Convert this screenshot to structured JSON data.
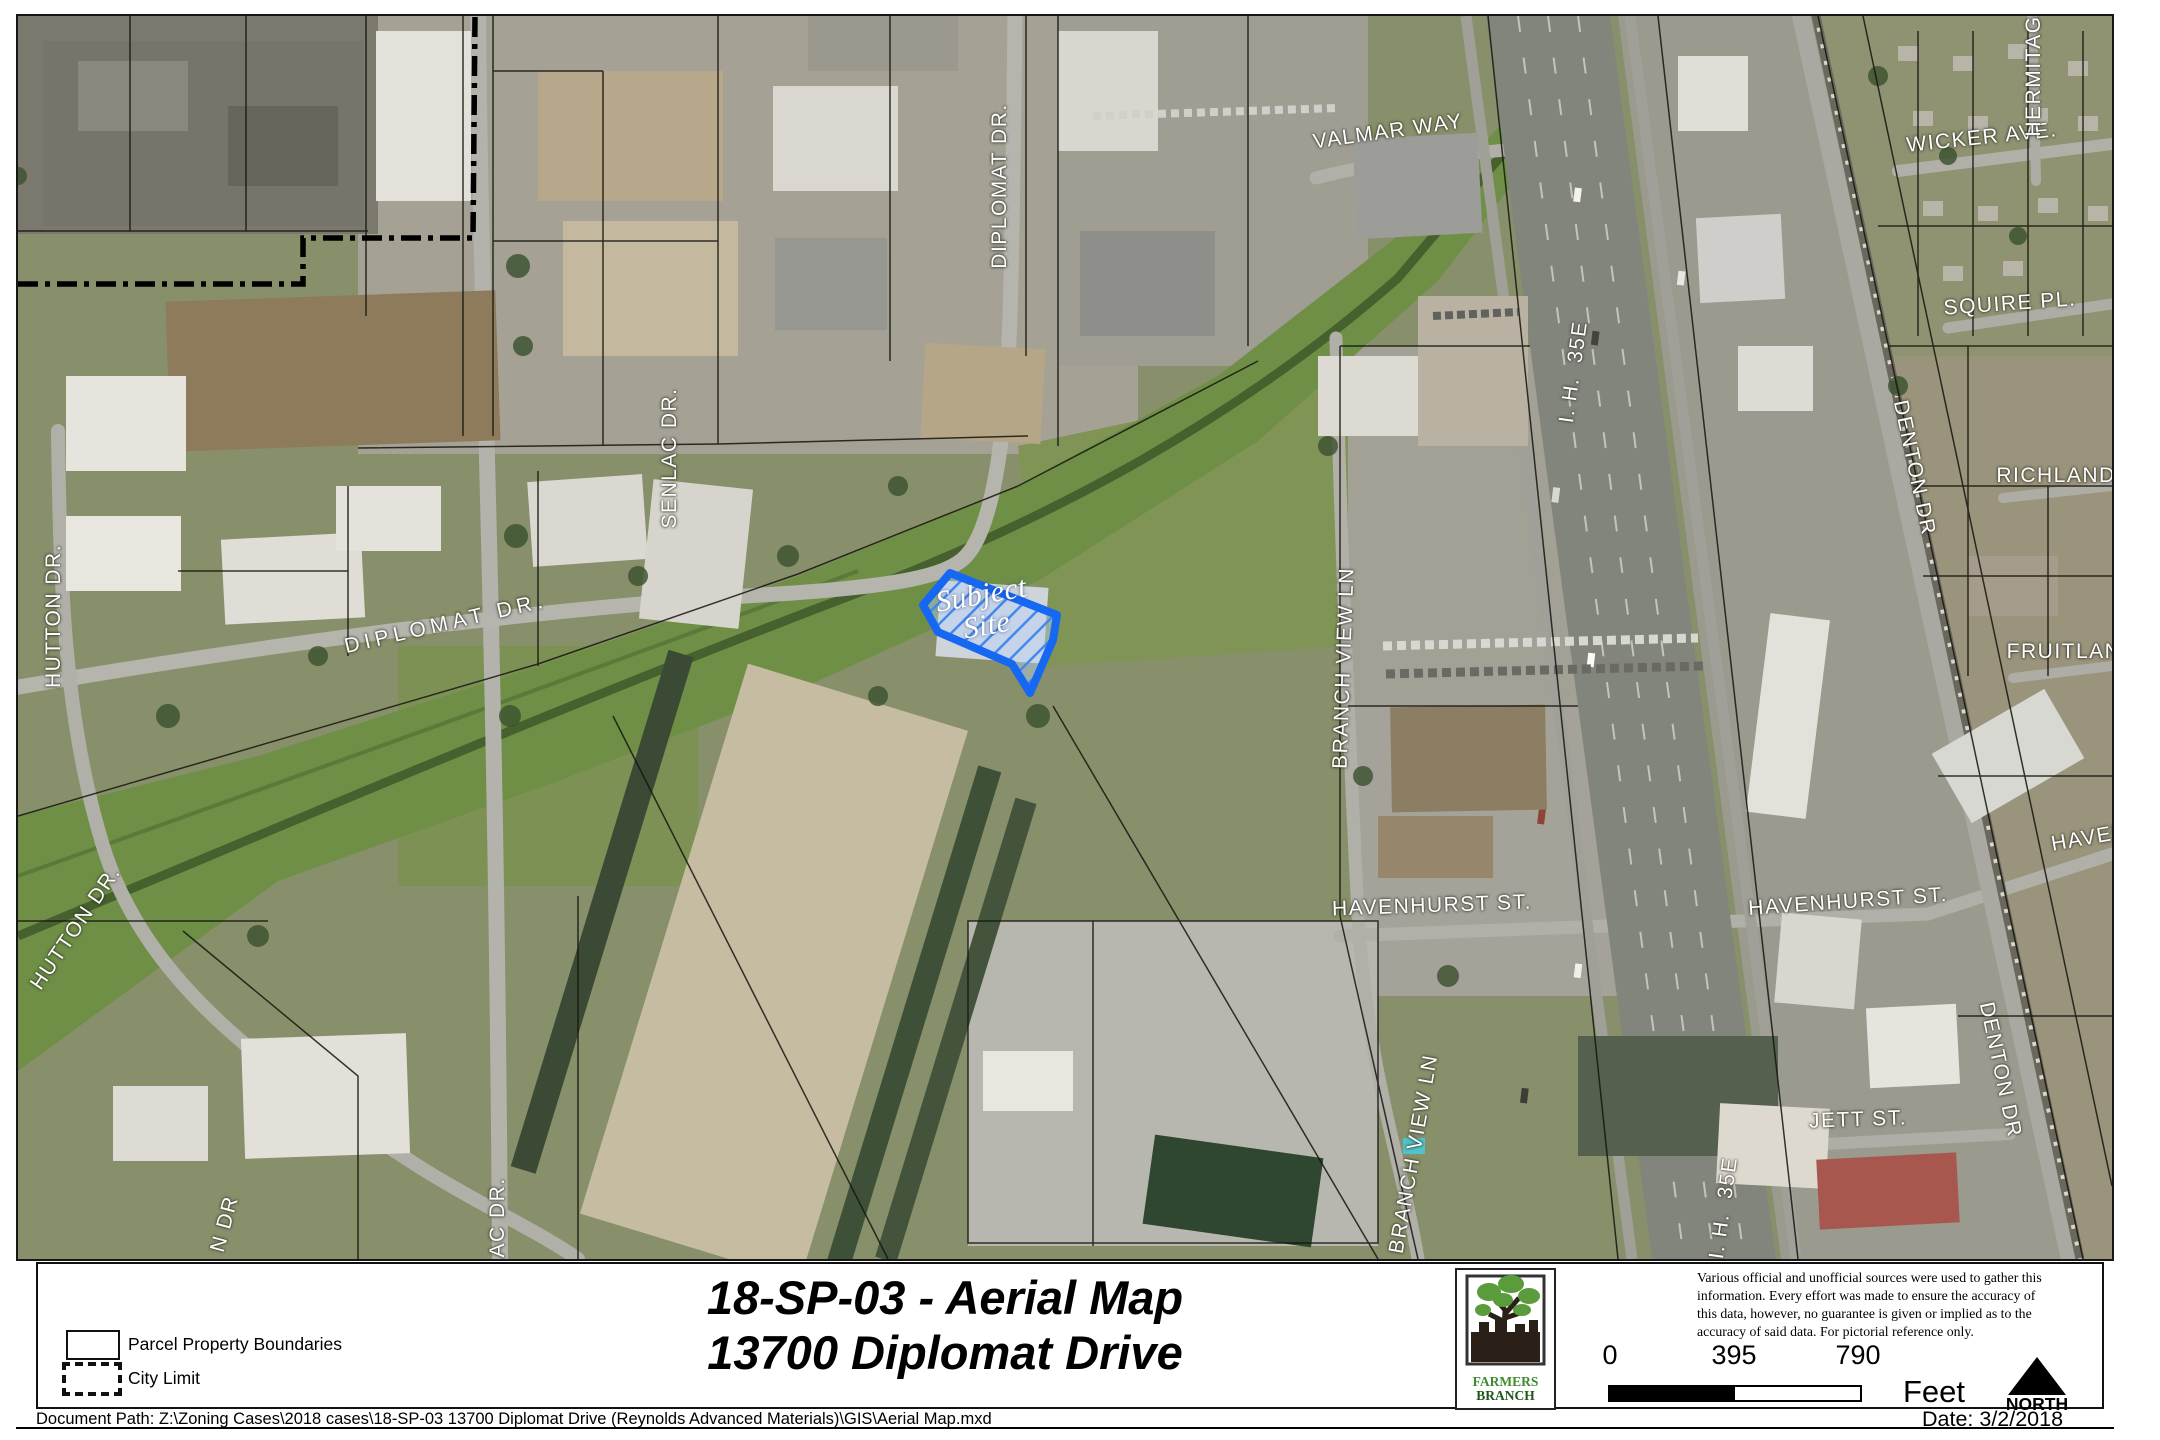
{
  "map": {
    "subject_outline_color": "#1668f2",
    "label_color": "#ffffff",
    "labels": [
      {
        "text": "HUTTON DR.",
        "x": 36,
        "y": 600,
        "rot": -90
      },
      {
        "text": "HUTTON DR.",
        "x": 58,
        "y": 912,
        "rot": -56
      },
      {
        "text": "N DR",
        "x": 207,
        "y": 1208,
        "rot": -75
      },
      {
        "text": "SENLAC DR.",
        "x": 652,
        "y": 442,
        "rot": -90
      },
      {
        "text": "LAC DR.",
        "x": 480,
        "y": 1208,
        "rot": -90
      },
      {
        "text": "DIPLOMAT DR.",
        "x": 982,
        "y": 170,
        "rot": -90
      },
      {
        "text": "DIPLOMAT DR.",
        "x": 428,
        "y": 608,
        "rot": -13,
        "cls": "spread"
      },
      {
        "text": "VALMAR WAY",
        "x": 1370,
        "y": 116,
        "rot": -8
      },
      {
        "text": "I. H.  35E",
        "x": 1556,
        "y": 356,
        "rot": -82
      },
      {
        "text": "I. H.  35E",
        "x": 1706,
        "y": 1192,
        "rot": -82
      },
      {
        "text": "BRANCH VIEW LN",
        "x": 1326,
        "y": 652,
        "rot": -88
      },
      {
        "text": "BRANCH VIEW LN",
        "x": 1396,
        "y": 1138,
        "rot": -80
      },
      {
        "text": "HAVENHURST ST.",
        "x": 1414,
        "y": 890,
        "rot": -2
      },
      {
        "text": "HAVENHURST ST.",
        "x": 1830,
        "y": 886,
        "rot": -4
      },
      {
        "text": "HAVEN",
        "x": 2072,
        "y": 822,
        "rot": -10
      },
      {
        "text": "JETT ST.",
        "x": 1840,
        "y": 1104,
        "rot": -2
      },
      {
        "text": "DENTON DR",
        "x": 1896,
        "y": 452,
        "rot": 78
      },
      {
        "text": "DENTON DR",
        "x": 1982,
        "y": 1054,
        "rot": 78
      },
      {
        "text": "WICKER AVE.",
        "x": 1964,
        "y": 122,
        "rot": -6
      },
      {
        "text": "SQUIRE PL.",
        "x": 1992,
        "y": 288,
        "rot": -4
      },
      {
        "text": "RICHLAND",
        "x": 2038,
        "y": 460,
        "rot": 0
      },
      {
        "text": "FRUITLAN",
        "x": 2046,
        "y": 636,
        "rot": 0
      },
      {
        "text": "HERMITAG",
        "x": 2016,
        "y": 60,
        "rot": -90
      },
      {
        "text": "Subject Site",
        "x": 966,
        "y": 594,
        "rot": -10,
        "cls": "subject"
      }
    ]
  },
  "legend": {
    "items": [
      {
        "label": "Parcel Property Boundaries",
        "swatch": "solid-outline"
      },
      {
        "label": "City Limit",
        "swatch": "bold-dashed-outline"
      }
    ]
  },
  "title_block": {
    "line1": "18-SP-03 -  Aerial Map",
    "line2": "13700 Diplomat Drive"
  },
  "logo": {
    "line1": "FARMERS",
    "line2": "BRANCH"
  },
  "disclaimer": {
    "lines": [
      "Various official and unofficial sources were used to gather this",
      "information. Every effort was made to ensure the accuracy of",
      "this data, however, no guarantee is given or implied as to the",
      "accuracy of said data.  For pictorial reference only."
    ]
  },
  "scale_bar": {
    "ticks": [
      "0",
      "395",
      "790"
    ],
    "unit": "Feet"
  },
  "north": {
    "label": "NORTH"
  },
  "date_label": "Date: 3/2/2018",
  "footer": {
    "document_path": "Document Path: Z:\\Zoning Cases\\2018 cases\\18-SP-03 13700 Diplomat Drive (Reynolds Advanced Materials)\\GIS\\Aerial Map.mxd"
  }
}
